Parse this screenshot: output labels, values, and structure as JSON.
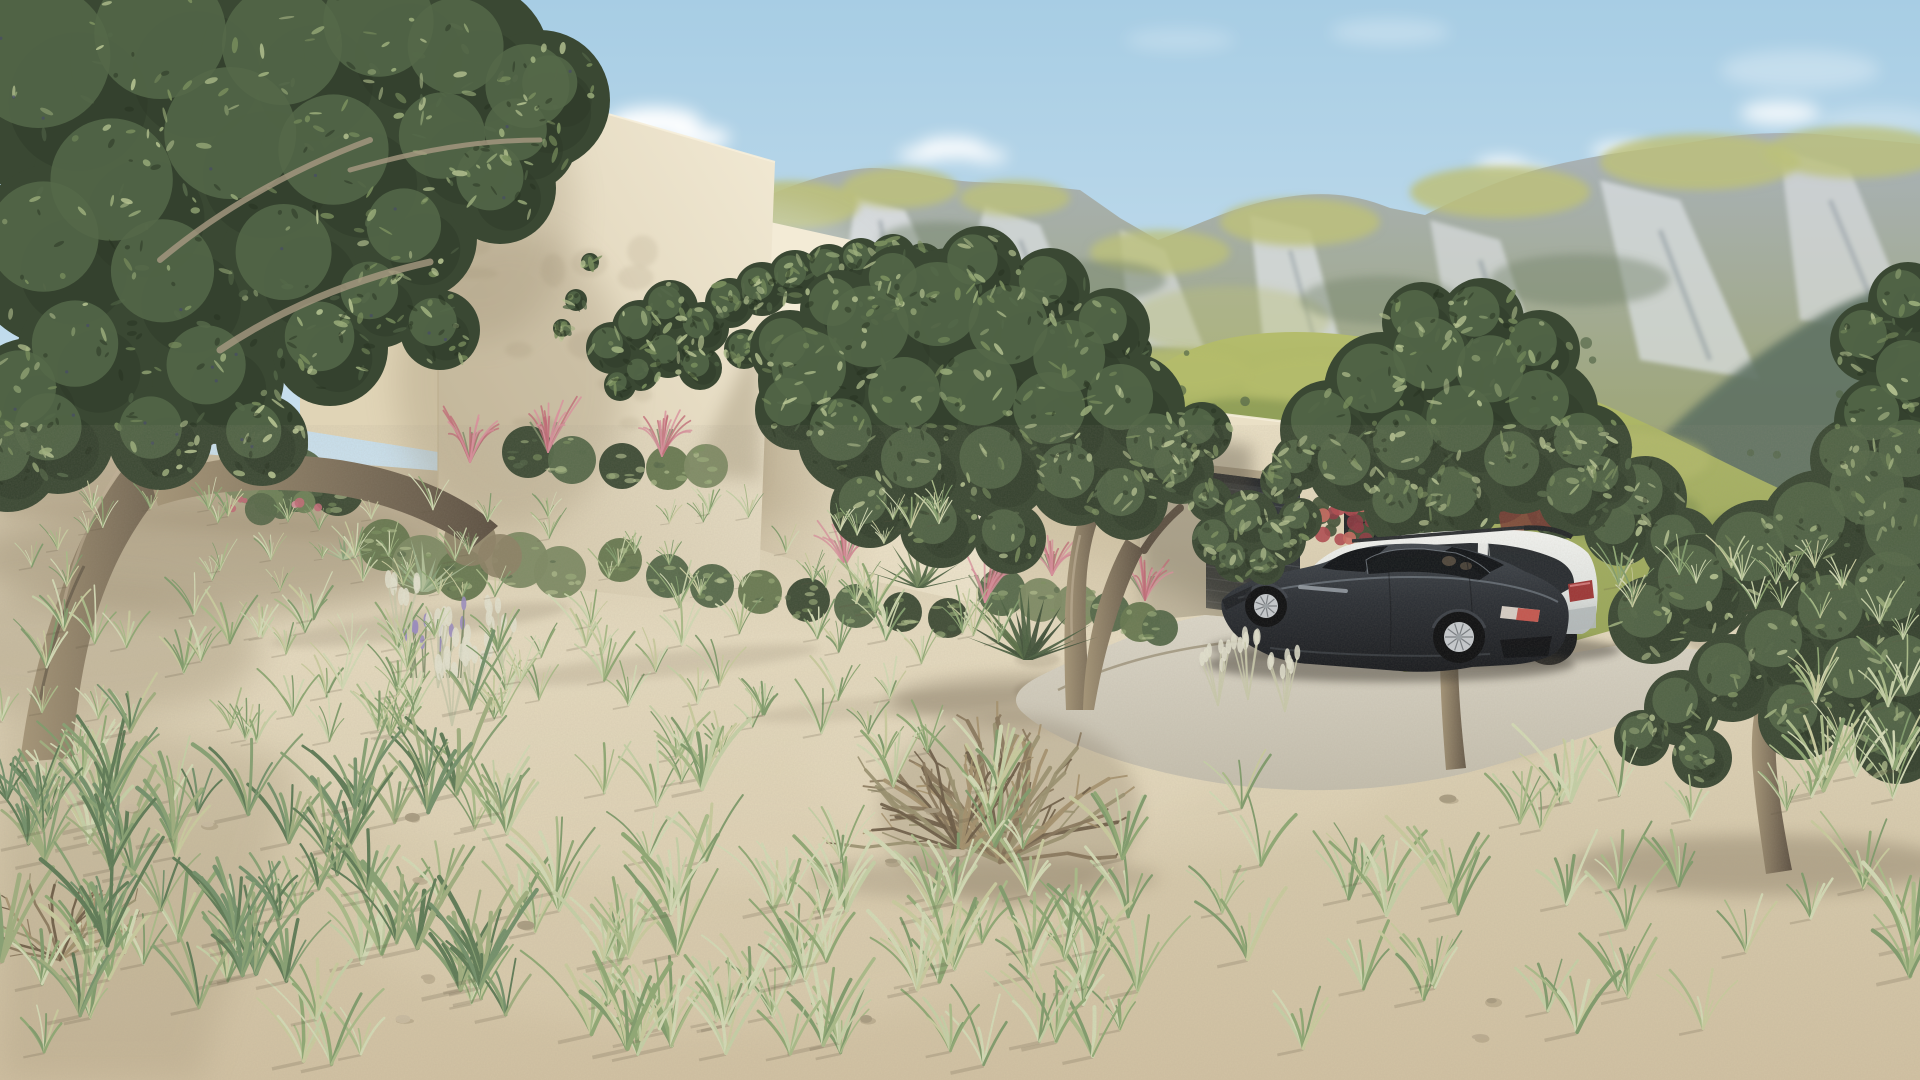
{
  "meta": {
    "title": "Exterior 3D rendering of a modern desert villa",
    "width": 1920,
    "height": 1080
  },
  "scene": {
    "sky": "clear pale-blue sky with small white clouds",
    "mountains": "rocky mountain range with olive-green grassy slopes and grey limestone outcrops",
    "foothills": "sunlit yellow-green foothills behind the house",
    "villa": "modern flat-roofed beige stucco villa with stepped volumes and parapet caps",
    "stone_wall": "rubble stone garden wall fragment behind the roof terrace",
    "rooftop_shrubs": "green shrubs rising behind the roof parapet",
    "garage_door": "dark slatted garage door",
    "garage_window": "tall dark-framed vertical window",
    "red_flower_bush": "red flowering bush at the garage wall",
    "driveway": "light concrete parking pad",
    "sports_car": "dark charcoal luxury fastback coupe with silver alloy wheels",
    "suv": "white crossover wagon with tinted glass parked behind the coupe",
    "olive_trees": "four gnarled olive trees framing the scene",
    "grass": "pale sage bunch grasses scattered over sandy ground",
    "dry_shrub": "large dry tumbleweed-like shrub in the foreground",
    "agave": "agave and yucca rosettes",
    "pink_grass": "pink muhly grass clusters at the walls",
    "lavender": "lavender flower spikes",
    "terrain": "sloping pale sandy terrain"
  },
  "palette": {
    "sky_top": "#a7cde4",
    "sky_mid": "#c2dcec",
    "sky_horizon": "#dcebf2",
    "cloud_white": "#ffffff",
    "rock_light": "#dde1e4",
    "rock_mid": "#a9b2ba",
    "rock_dark": "#7b8790",
    "mountain_grass": "#9aa468",
    "mountain_grass_light": "#bcc07b",
    "mountain_shadow": "#74836b",
    "mountain_deep": "#5e7263",
    "haze_white": "#dfe8ec",
    "foothill": "#94a355",
    "foothill_light": "#b4bc6c",
    "foothill_dark": "#75894c",
    "wall_bright": "#f3ebd6",
    "wall_lit": "#ece2c8",
    "wall_left": "#e0d4b6",
    "wall_shade": "#d3c6a8",
    "wall_deep": "#c0b295",
    "cap_shadow": "#a4967a",
    "stone_base": "#847e72",
    "door_dark": "#2e3236",
    "door_slat": "#474c51",
    "window_dark": "#15181c",
    "frame_dark": "#212428",
    "sand_top": "#c7ba9e",
    "sand_light": "#e4d9be",
    "sand_mid": "#d7caac",
    "sand_warm": "#d2c2a3",
    "sand_shadow": "#ac9d82",
    "drive_light": "#dcd7c9",
    "drive_dark": "#c5bfae",
    "curb": "#94896f",
    "olive_dark": "#3a4833",
    "olive_mid": "#556849",
    "olive_light": "#7c915f",
    "olive_pale": "#9eb07d",
    "trunk_light": "#a69678",
    "trunk_dark": "#5c5042",
    "shadow_brown": "#6b5d48",
    "car_top": "#42484f",
    "car_mid": "#2a2e34",
    "car_low": "#17191d",
    "car_glass": "#0f1216",
    "car_rim": "#c7cbcf",
    "car_highlight": "#79828c",
    "taillight": "#c2423a",
    "suv_top": "#f4f5f2",
    "suv_mid": "#e3e6e3",
    "suv_low": "#b4babb",
    "suv_glass": "#1b2025",
    "suv_trim": "#2b2e31",
    "pink_bloom": "#d9909c",
    "pink_deep": "#c06b77",
    "red_bloom": "#b04a50",
    "lavender": "#9a8dc0",
    "stem_green": "#7a8a66",
    "plume": "#e3e2cf",
    "grass": [
      "#c5d0a6",
      "#a9bb88",
      "#8ea873",
      "#d3dab5",
      "#7f9b6b",
      "#c9cb9e"
    ],
    "grass_dark": [
      "#72906a",
      "#5d7a55",
      "#86a072",
      "#9fae7e"
    ],
    "agave_pale": [
      "#9fb28c",
      "#87a078",
      "#b4c29b"
    ],
    "agave_dark": [
      "#5d7350",
      "#74895f",
      "#4c6142"
    ],
    "dry_twig": [
      "#a4906c",
      "#87755a",
      "#6a5a44",
      "#99906f"
    ],
    "stone_tones": [
      "#aaa498",
      "#968f82",
      "#857e71",
      "#b5afa2",
      "#736d60"
    ],
    "olive_speckle": [
      "#7c915f",
      "#9eb07d",
      "#b7c492",
      "#556849"
    ]
  }
}
